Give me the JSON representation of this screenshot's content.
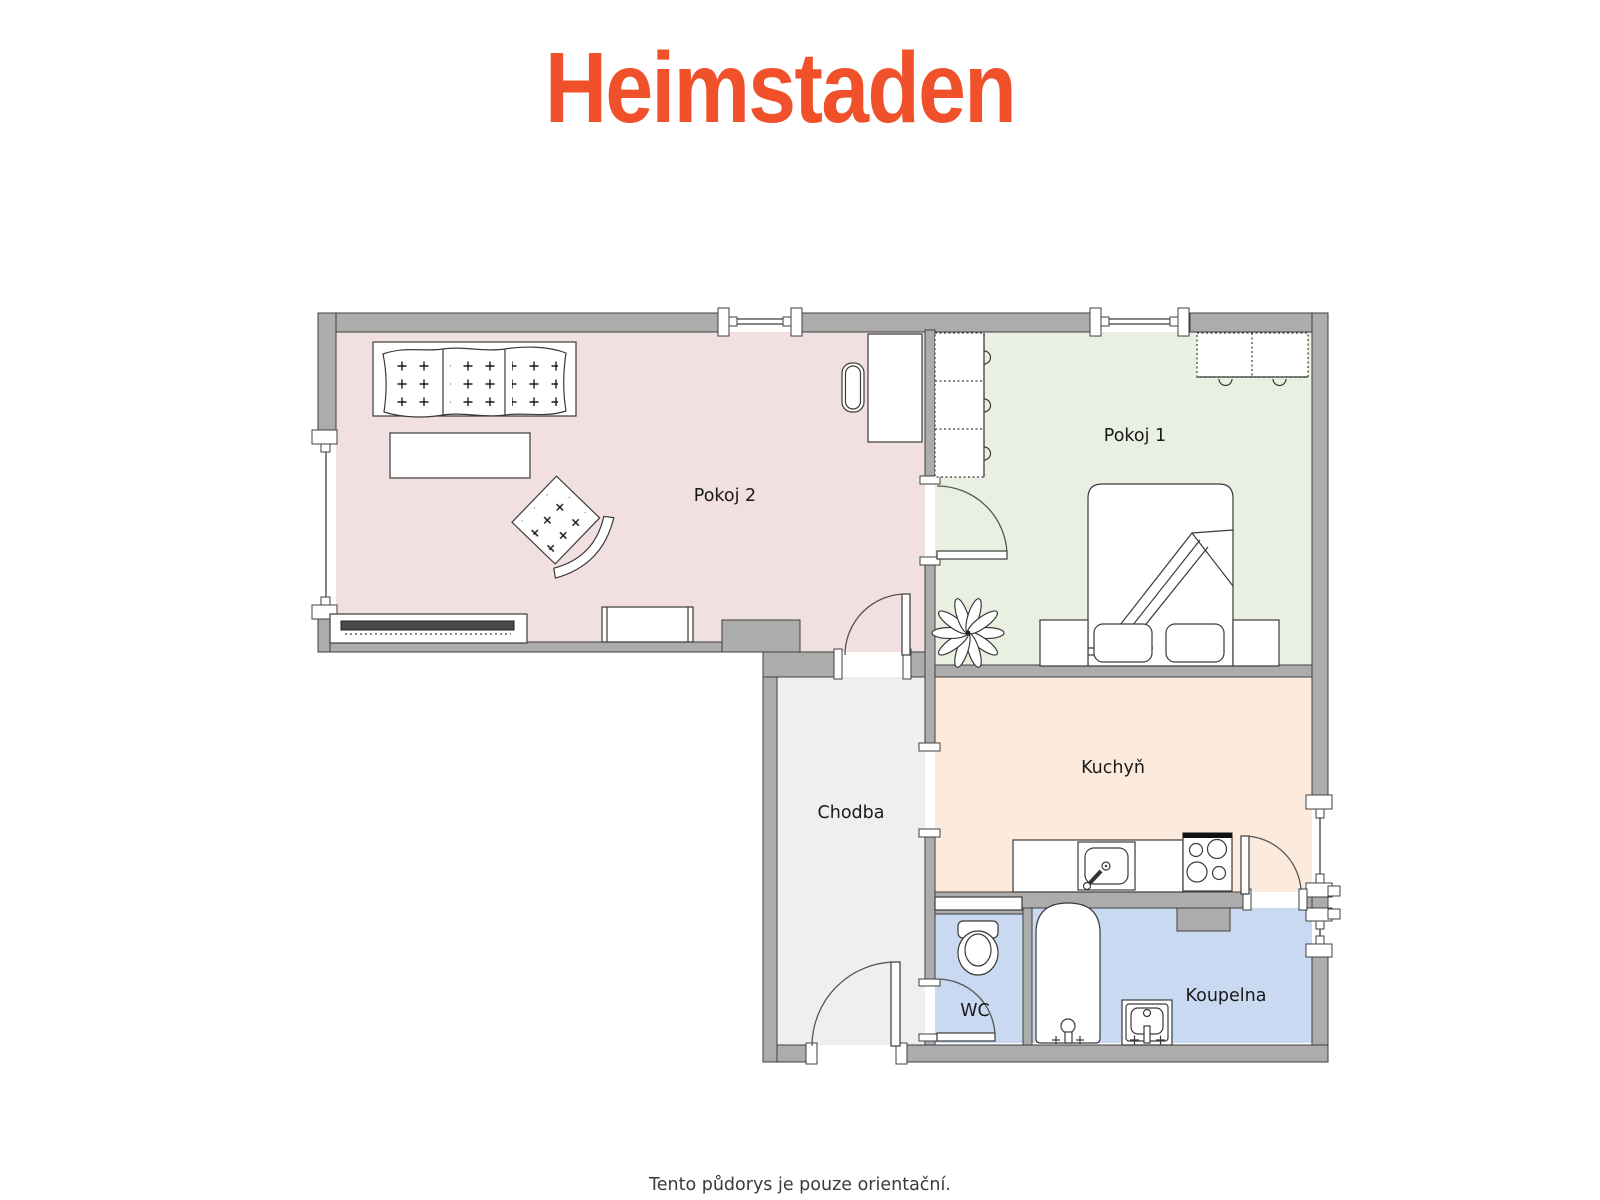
{
  "logo": {
    "text": "Heimstaden",
    "color": "#F0502A"
  },
  "floorplan": {
    "wall_color": "#ACACAC",
    "outline_color": "#3F3F3F",
    "colors": {
      "pokoj2": "#F2DFDF",
      "pokoj1": "#E9EFE1",
      "kuchyn": "#FCEBDC",
      "chodba": "#EFEFEF",
      "wc": "#C8D9F1",
      "koupelna": "#C8D9F1"
    },
    "labels": {
      "pokoj2": "Pokoj 2",
      "pokoj1": "Pokoj 1",
      "kuchyn": "Kuchyň",
      "chodba": "Chodba",
      "wc": "WC",
      "koupelna": "Koupelna"
    }
  },
  "footer": {
    "disclaimer": "Tento půdorys je pouze orientační.",
    "color": "#3A3A3A"
  }
}
